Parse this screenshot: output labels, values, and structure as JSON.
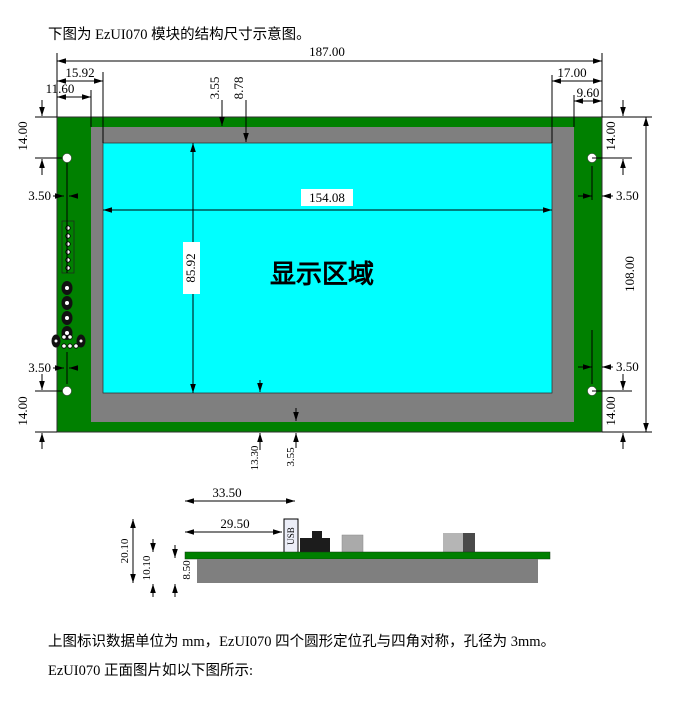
{
  "document": {
    "intro": "下图为 EzUI070 模块的结构尺寸示意图。",
    "unit_note": "上图标识数据单位为 mm，EzUI070 四个圆形定位孔与四角对称，孔径为 3mm。",
    "front_view_caption": "EzUI070 正面图片如以下图所示:"
  },
  "top_view": {
    "display_area_label": "显示区域",
    "dims": {
      "total_width": "187.00",
      "total_height": "108.00",
      "display_width": "154.08",
      "display_height": "85.92",
      "left_display_offset": "15.92",
      "left_bezel_offset": "11.60",
      "top_bezel_offset": "3.55",
      "top_display_offset": "8.78",
      "right_display_offset": "17.00",
      "right_bezel_offset": "9.60",
      "bottom_display_offset": "13.30",
      "bottom_bezel_offset": "3.55",
      "hole_offset_vertical": "14.00",
      "hole_offset_horizontal": "3.50"
    }
  },
  "side_view": {
    "usb_label": "USB",
    "dims": {
      "usb_right_offset": "33.50",
      "usb_left_offset": "29.50",
      "total_thickness": "20.10",
      "pcb_panel_thickness": "10.10",
      "panel_thickness": "8.50"
    }
  },
  "colors": {
    "pcb_green": "#008000",
    "bezel_gray": "#7f7f7f",
    "display_cyan": "#00ffff",
    "component_dark": "#1c1c1c",
    "component_light": "#b0b0b0"
  }
}
